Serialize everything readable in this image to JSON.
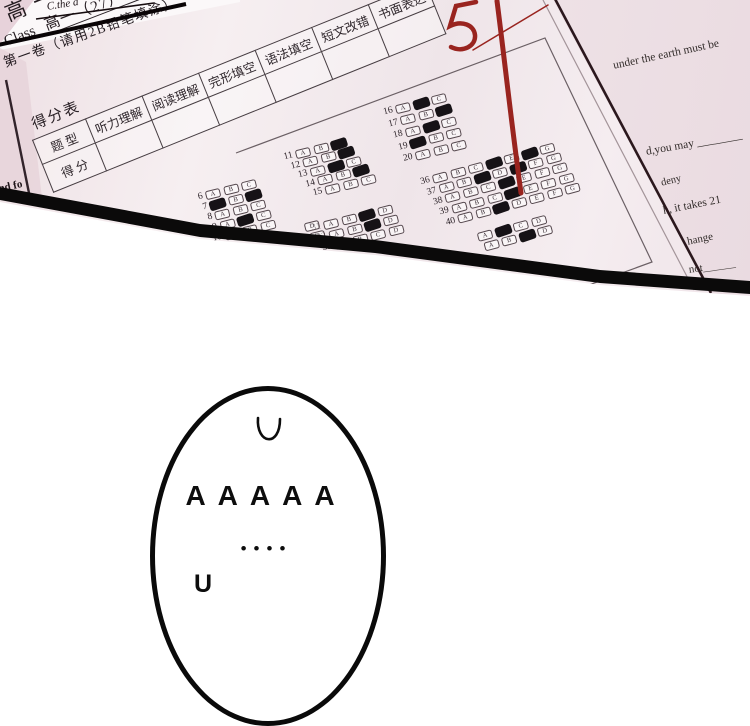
{
  "panel": {
    "background_fragments": {
      "corner_text": "C.the a",
      "left_edge_text": "ad fo"
    },
    "answer_sheet": {
      "title_fragment": "高一英语期中考试",
      "class_label": "Class",
      "class_value": "高一（27）班",
      "score_table": {
        "label": "得分表",
        "columns": [
          "题 型",
          "听力理解",
          "阅读理解",
          "完形填空",
          "语法填空",
          "短文改错",
          "书面表达"
        ],
        "row2_label": "得 分"
      },
      "section_header": "第一卷（请用2B铅笔填涂）",
      "red_score_mark": "51",
      "bubble_blocks": [
        {
          "id": "q6-10",
          "options": [
            "A",
            "B",
            "C"
          ],
          "rows": [
            {
              "n": "6",
              "filled": []
            },
            {
              "n": "7",
              "filled": [
                "A",
                "C"
              ]
            },
            {
              "n": "8",
              "filled": []
            },
            {
              "n": "9",
              "filled": [
                "B"
              ]
            },
            {
              "n": "10",
              "filled": []
            }
          ]
        },
        {
          "id": "q11-15",
          "options": [
            "A",
            "B",
            "C"
          ],
          "rows": [
            {
              "n": "11",
              "filled": [
                "C"
              ]
            },
            {
              "n": "12",
              "filled": [
                "C"
              ]
            },
            {
              "n": "13",
              "filled": [
                "B"
              ]
            },
            {
              "n": "14",
              "filled": [
                "C"
              ]
            },
            {
              "n": "15",
              "filled": []
            }
          ]
        },
        {
          "id": "q16-20",
          "options": [
            "A",
            "B",
            "C"
          ],
          "rows": [
            {
              "n": "16",
              "filled": [
                "B"
              ]
            },
            {
              "n": "17",
              "filled": [
                "C"
              ]
            },
            {
              "n": "18",
              "filled": [
                "B"
              ]
            },
            {
              "n": "19",
              "filled": [
                "A"
              ]
            },
            {
              "n": "20",
              "filled": []
            }
          ]
        },
        {
          "id": "q31-35",
          "options": [
            "A",
            "B",
            "C",
            "D"
          ],
          "rows": [
            {
              "n": "31",
              "filled": [
                "C"
              ]
            },
            {
              "n": "32",
              "filled": [
                "C"
              ]
            },
            {
              "n": "33",
              "filled": []
            }
          ]
        },
        {
          "id": "q36-40",
          "options": [
            "A",
            "B",
            "C",
            "D",
            "E",
            "F",
            "G"
          ],
          "rows": [
            {
              "n": "36",
              "filled": [
                "D",
                "F"
              ]
            },
            {
              "n": "37",
              "filled": [
                "C",
                "E"
              ]
            },
            {
              "n": "38",
              "filled": [
                "D"
              ]
            },
            {
              "n": "39",
              "filled": [
                "D"
              ]
            },
            {
              "n": "40",
              "filled": [
                "C"
              ]
            }
          ]
        },
        {
          "id": "q-extra",
          "options": [
            "A",
            "B",
            "C",
            "D"
          ],
          "rows": [
            {
              "n": "",
              "filled": [
                "B"
              ]
            },
            {
              "n": "",
              "filled": [
                "C"
              ]
            }
          ]
        },
        {
          "id": "d-col",
          "options": [
            "D"
          ],
          "rows": [
            {
              "n": "",
              "filled": []
            },
            {
              "n": "",
              "filled": []
            }
          ]
        }
      ]
    },
    "side_sheet": {
      "lines": [
        "under the earth must be",
        "d,you may ________",
        "deny",
        "h, it takes 21",
        "hange",
        "not______"
      ]
    }
  },
  "balloon": {
    "top_mark": "∪",
    "scream": "AAAAA",
    "dots": "••••",
    "bottom_fragment": "U"
  },
  "colors": {
    "paper_pink": "#e8d6dc",
    "sheet_white": "#f7f0f2",
    "red_pen": "#99241f",
    "ink": "#17090b",
    "panel_border": "#0b0a0a"
  }
}
